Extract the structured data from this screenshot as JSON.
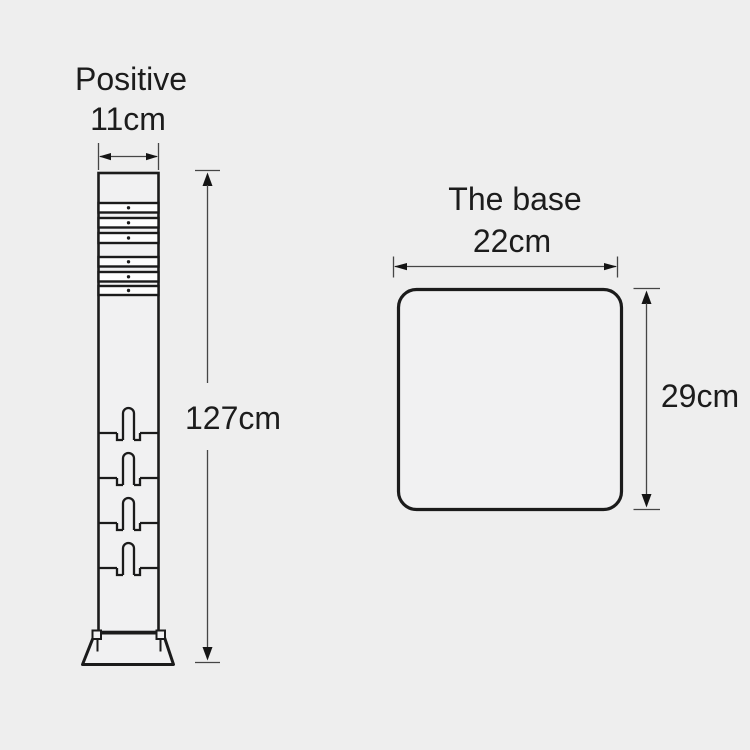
{
  "diagram": {
    "type": "product-dimension-drawing",
    "post_figure": {
      "title": "Positive",
      "width_label": "11cm",
      "height_label": "127cm",
      "features": {
        "reflective_bands": 6,
        "mounting_slots": 4
      }
    },
    "base_figure": {
      "title": "The base",
      "width_label": "22cm",
      "height_label": "29cm"
    },
    "colors": {
      "background": "#eeeeee",
      "outline": "#1b1b1b",
      "dimension_lines": "#454545",
      "text": "#1c1c1c"
    }
  }
}
